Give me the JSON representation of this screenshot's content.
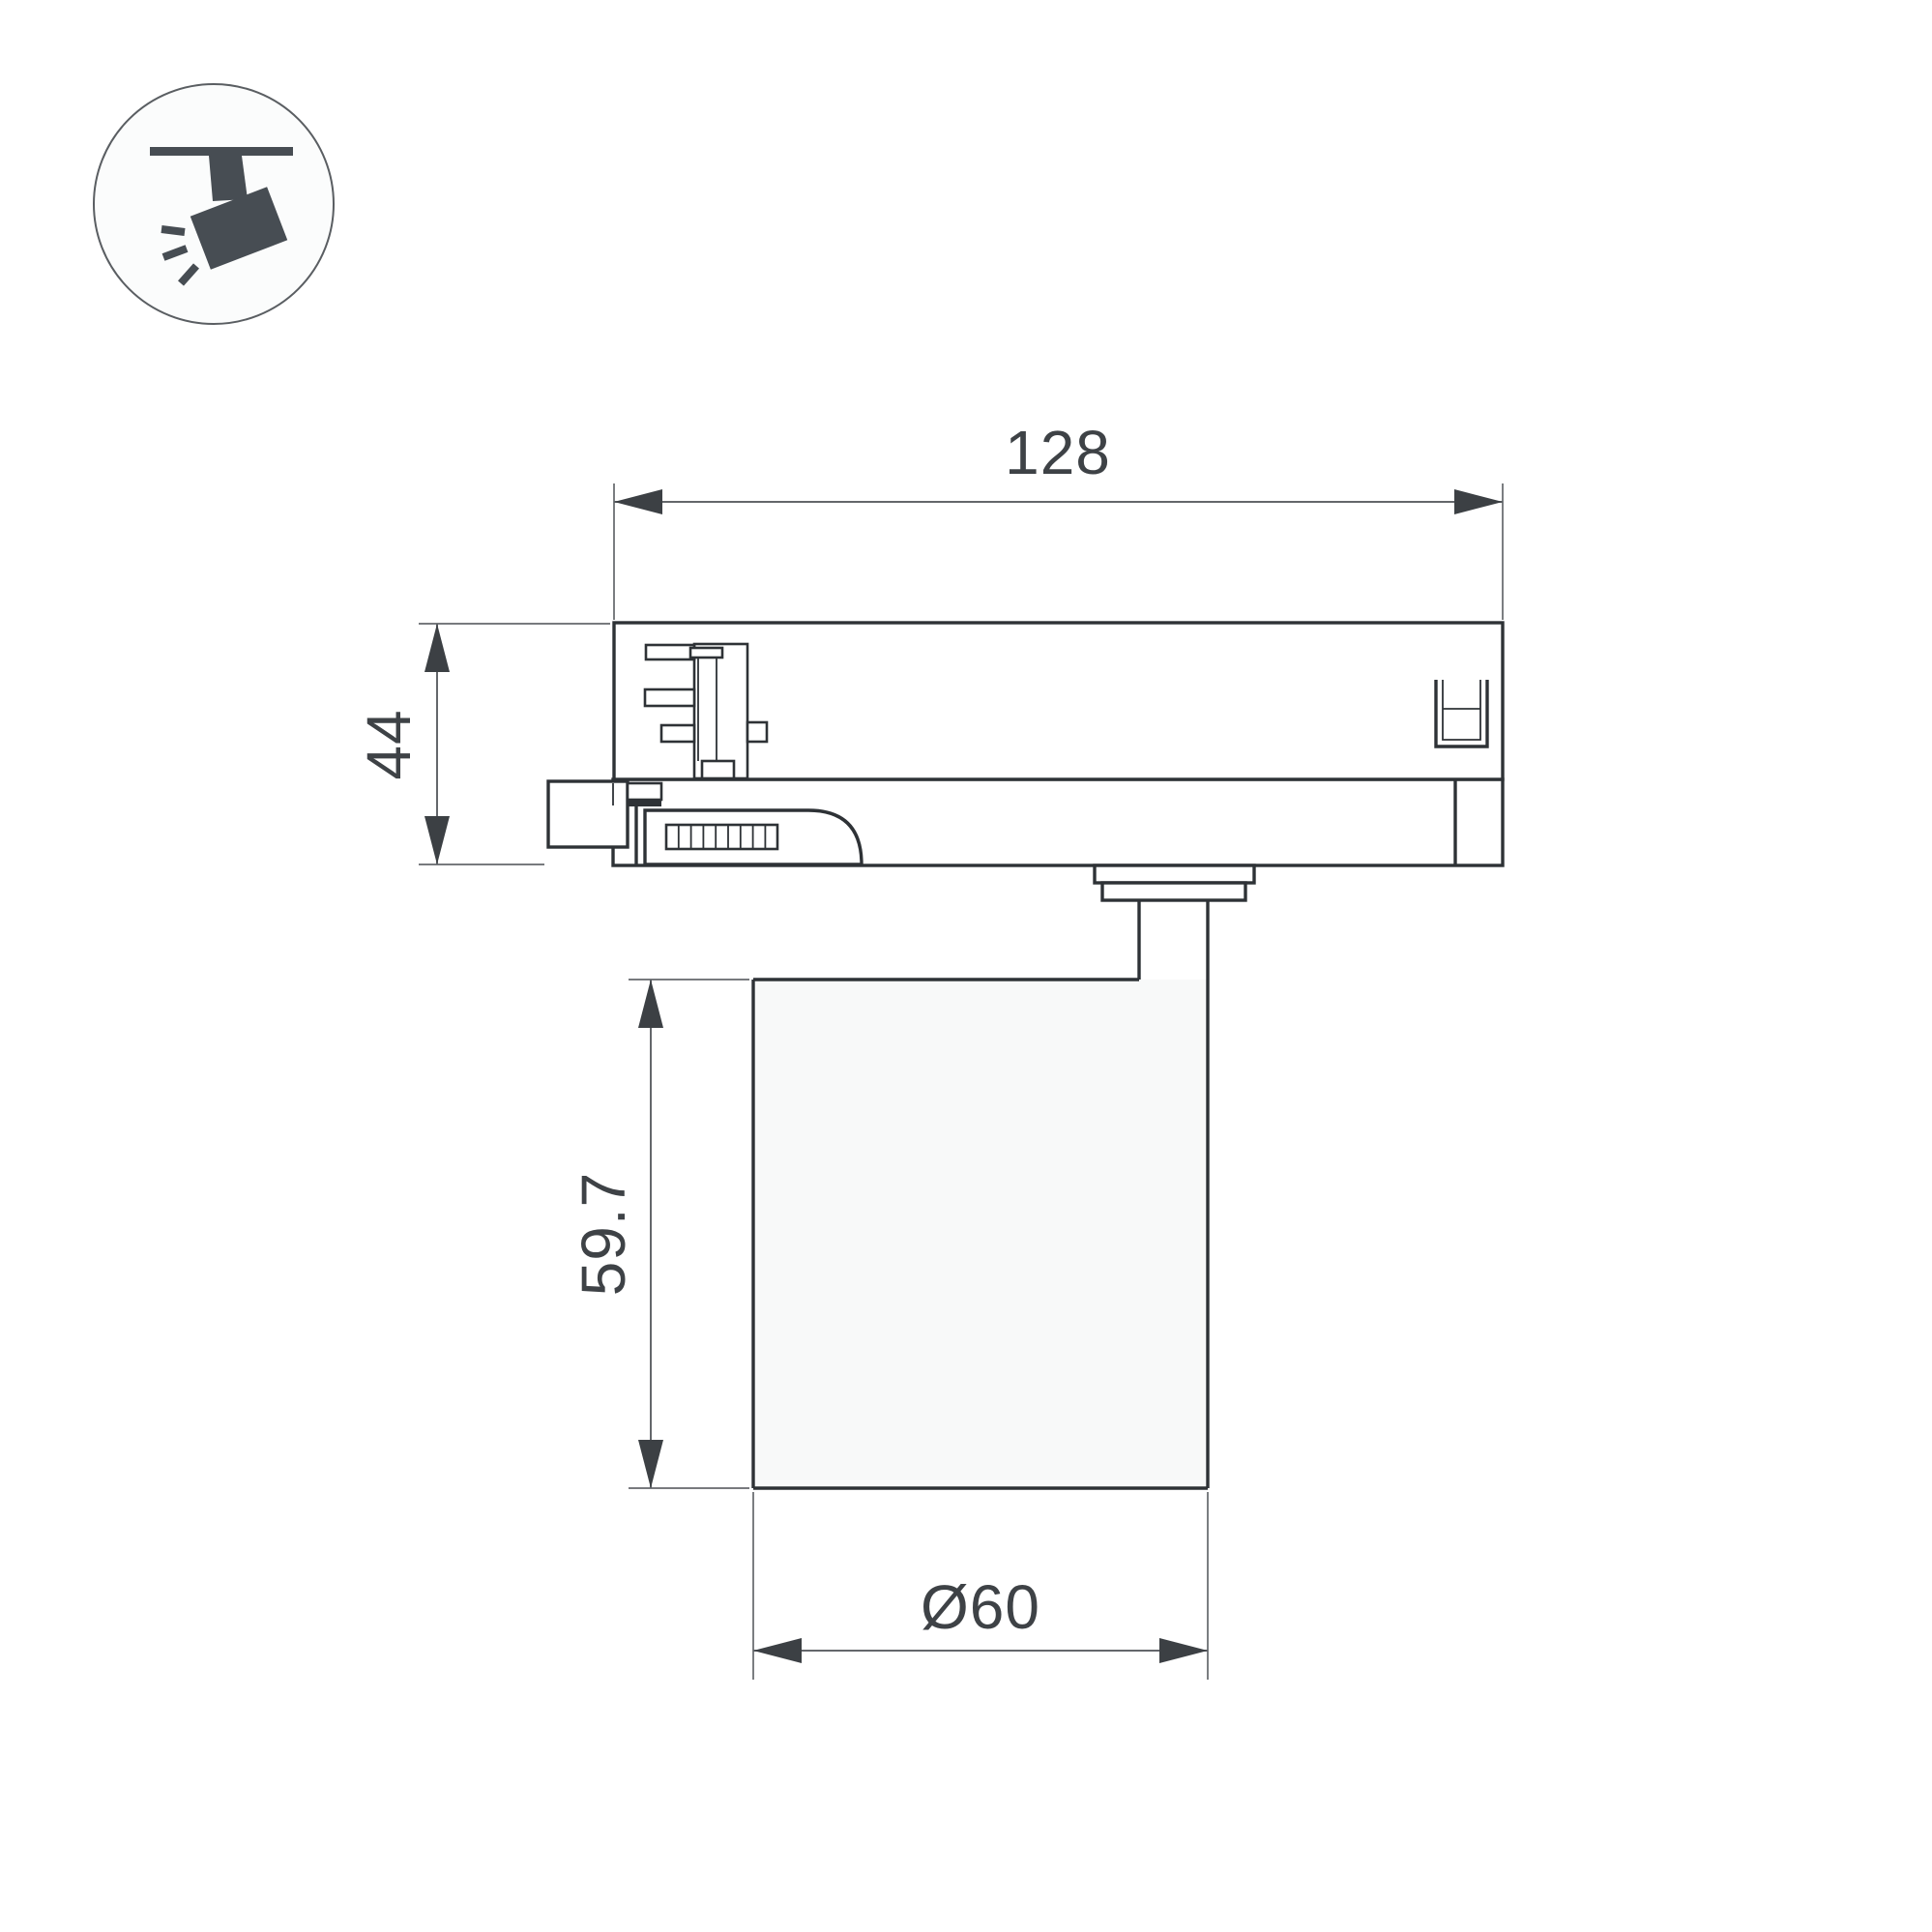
{
  "drawing": {
    "kind": "technical-dimension-drawing",
    "subject": "track-mounted spotlight luminaire, side view"
  },
  "icon": {
    "name": "track-spotlight-icon",
    "description": "ceiling track with tilted spotlight head and light rays"
  },
  "dims": {
    "track_width": {
      "value": "128"
    },
    "adapter_height": {
      "value": "44"
    },
    "body_height": {
      "value": "59.7"
    },
    "body_diameter": {
      "value": "Ø60"
    }
  },
  "colors": {
    "background": "#ffffff",
    "outline": "#2e3236",
    "thin_line": "#64676b",
    "arrow": "#3c4044",
    "dimension_text": "#3e4246",
    "icon_glyph": "#474d53",
    "icon_circle_stroke": "#5a5e62",
    "icon_circle_fill": "#fbfcfc",
    "body_fill": "#f8f9f9"
  }
}
